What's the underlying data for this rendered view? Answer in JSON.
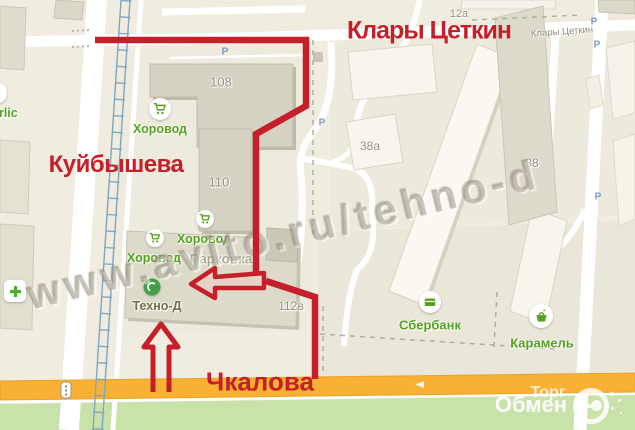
{
  "route": {
    "street_top": "Клары Цеткин",
    "street_left": "Куйбышева",
    "street_bottom": "Чкалова",
    "color": "#c5202a"
  },
  "watermark": {
    "text": "www.avito.ru/tehno-d"
  },
  "logo": {
    "word_top": "Торг",
    "word_bottom": "Обмен"
  },
  "map": {
    "street_label_small": "Клары Цеткин",
    "parking_letter": "P",
    "parking_area_label": "Парковка",
    "buildings": [
      {
        "label": "108"
      },
      {
        "label": "110"
      },
      {
        "label": "112в"
      },
      {
        "label": "12а"
      },
      {
        "label": "38а"
      },
      {
        "label": "38"
      }
    ],
    "pois": [
      {
        "label": "Хоровод"
      },
      {
        "label": "Хоровод"
      },
      {
        "label": "Хоровод"
      },
      {
        "label": "Техно-Д"
      },
      {
        "label": "Сбербанк"
      },
      {
        "label": "Карамель"
      },
      {
        "label": "erlic"
      }
    ]
  },
  "palette": {
    "annotation_red": "#c5202a",
    "poi_green": "#56a21e",
    "road_orange": "#f8b133",
    "park_green": "#c9e2a9",
    "tram_blue": "#7fa6c2"
  }
}
